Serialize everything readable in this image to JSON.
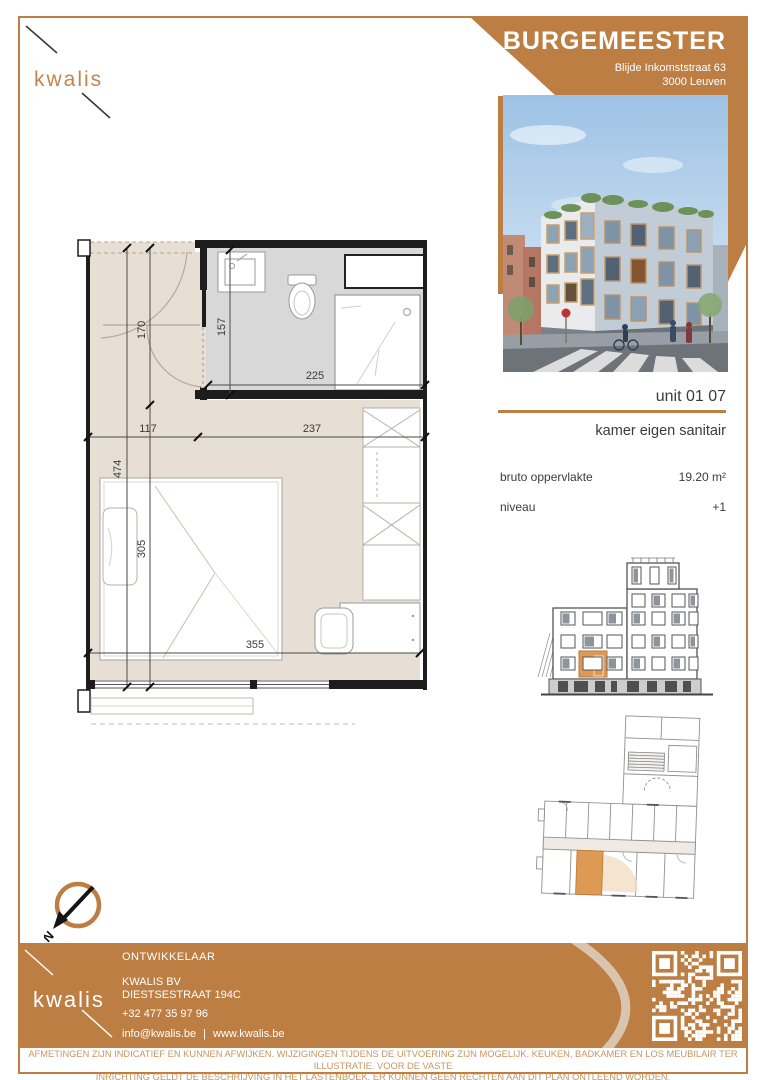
{
  "brand": {
    "logo_text": "kwalis"
  },
  "header": {
    "project_name": "BURGEMEESTER",
    "address_line1": "Blijde Inkomststraat 63",
    "address_line2": "3000 Leuven"
  },
  "unit": {
    "number": "unit 01 07",
    "type": "kamer eigen sanitair",
    "area_label": "bruto oppervlakte",
    "area_value": "19.20 m²",
    "level_label": "niveau",
    "level_value": "+1"
  },
  "floorplan": {
    "dim_total_height": "474",
    "dim_entry_height": "170",
    "dim_bed_zone_height": "305",
    "dim_bath_height": "157",
    "dim_bath_width": "225",
    "dim_entry_width": "117",
    "dim_room_width_right": "237",
    "dim_total_width": "355"
  },
  "compass": {
    "north_label": "N"
  },
  "footer": {
    "role_label": "ONTWIKKELAAR",
    "company_name": "KWALIS BV",
    "street": "DIESTSESTRAAT 194C",
    "phone": "+32 477 35 97 96",
    "email": "info@kwalis.be",
    "separator": "|",
    "website": "www.kwalis.be",
    "logo_text": "kwalis"
  },
  "disclaimer": {
    "line1": "AFMETINGEN ZIJN INDICATIEF EN KUNNEN AFWIJKEN. WIJZIGINGEN TIJDENS DE UITVOERING ZIJN MOGELIJK. KEUKEN, BADKAMER EN LOS MEUBILAIR TER ILLUSTRATIE. VOOR DE VASTE",
    "line2": "INRICHTING GELDT DE BESCHRIJVING IN HET LASTENBOEK. ER KUNNEN GEEN RECHTEN AAN DIT PLAN ONTLEEND WORDEN."
  },
  "colors": {
    "accent_orange": "#bd7e44",
    "highlight_orange": "#dd9a55",
    "floor_beige": "#e7ded4",
    "bathroom_gray": "#d8d8d8",
    "swoosh_beige": "#dccdb9"
  }
}
